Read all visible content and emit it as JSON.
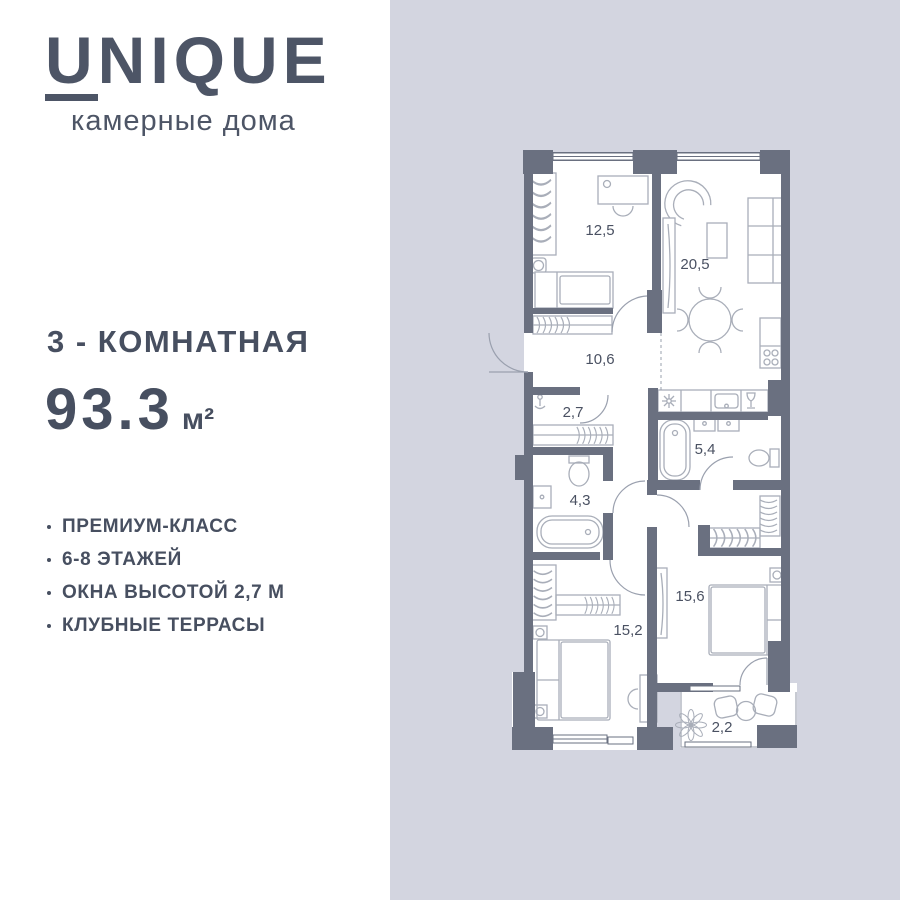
{
  "brand": {
    "initial": "U",
    "rest": "NIQUE",
    "tagline": "камерные дома"
  },
  "listing": {
    "title": "3 - КОМНАТНАЯ",
    "area_value": "93.3",
    "area_unit": "м²"
  },
  "features": [
    "ПРЕМИУМ-КЛАСС",
    "6-8 ЭТАЖЕЙ",
    "ОКНА ВЫСОТОЙ 2,7 М",
    "КЛУБНЫЕ ТЕРРАСЫ"
  ],
  "floorplan": {
    "room_labels": {
      "bedroom_top": "12,5",
      "living_kitchen": "20,5",
      "hallway": "10,6",
      "wardrobe": "2,7",
      "bathroom_main": "5,4",
      "bathroom_small": "4,3",
      "bedroom_left": "15,2",
      "bedroom_right": "15,6",
      "terrace": "2,2"
    }
  },
  "colors": {
    "ink": "#4d5566",
    "canvas": "#d3d5e0",
    "panel": "#ffffff",
    "wall": "#6a7080",
    "furniture": "#a9aeb9"
  }
}
